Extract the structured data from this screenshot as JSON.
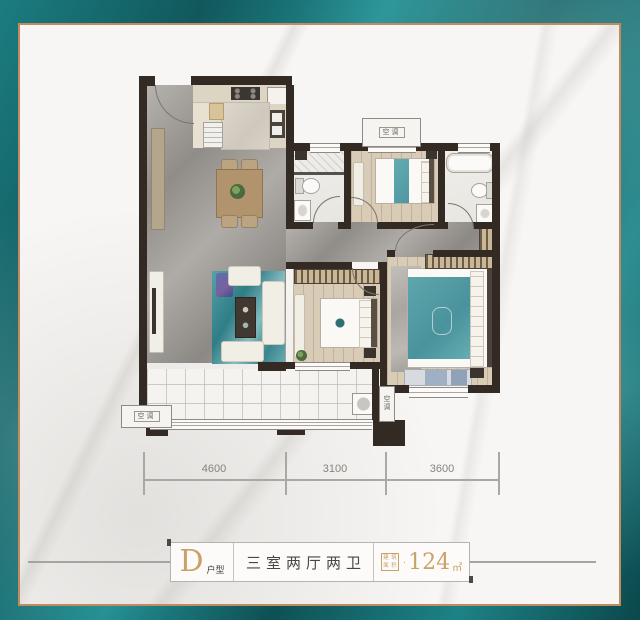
{
  "caption": {
    "type_letter": "D",
    "type_label": "户型",
    "rooms_label": "三室两厅两卫",
    "area_stamp_chars": [
      "建",
      "筑",
      "面",
      "积"
    ],
    "area_dot": "·",
    "area_value": "124",
    "area_unit": "㎡"
  },
  "dimensions": {
    "labels": [
      "4600",
      "3100",
      "3600"
    ]
  },
  "ac_platform": {
    "label": "空调",
    "chars": [
      "空",
      "调"
    ]
  },
  "colors": {
    "teal_border": "#156b6e",
    "gold_frame": "#c38a60",
    "accent_gold": "#c9a268",
    "wall": "#332a24",
    "bed_teal": "#5ba4ab"
  }
}
